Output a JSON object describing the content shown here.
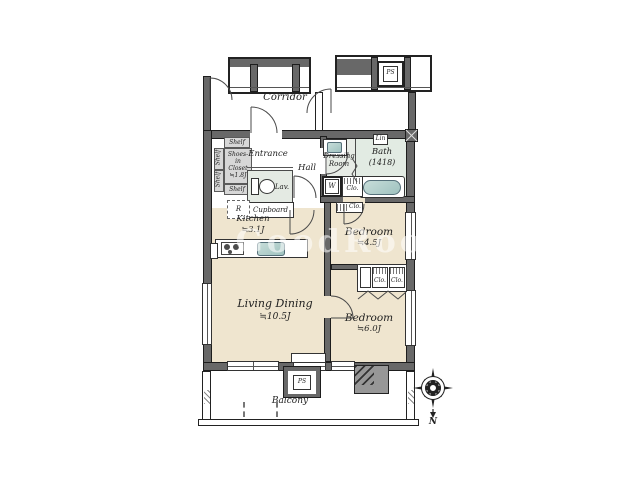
{
  "watermark": "GoodRooM",
  "corridor": {
    "label": "Corridor"
  },
  "top_structures": {
    "pipe_space": "PS"
  },
  "entrance_zone": {
    "entrance": "Entrance",
    "hall": "Hall",
    "lavatory": "Lav.",
    "cupboard": "Cupboard",
    "refrigerator": "R",
    "shelf_top": "Shelf",
    "shelf_side_upper": "Shelf",
    "shelf_side_lower": "Shelf",
    "shelf_bottom": "Shelf",
    "shoes_closet": "Shoes-in Closet ≒1.8J"
  },
  "kitchen": {
    "label": "Kitchen",
    "size": "≒3.1J"
  },
  "living_dining": {
    "label": "Living Dining",
    "size": "≒10.5J"
  },
  "bedroom1": {
    "label": "Bedroom",
    "size": "≒4.5J",
    "closet": "Clo."
  },
  "bedroom2": {
    "label": "Bedroom",
    "size": "≒6.0J",
    "closet_left": "Clo.",
    "closet_right": "Clo."
  },
  "dressing_room": {
    "label": "Dressing Room",
    "washer": "W",
    "closet": "Clo.",
    "linen": "Lin"
  },
  "bath": {
    "label": "Bath",
    "size": "(1418)"
  },
  "balcony": {
    "label": "Balcony",
    "hatch": "PS"
  },
  "compass": {
    "north": "N"
  },
  "colors": {
    "room_beige": "#efe5cf",
    "wet_gray": "#e4eae3",
    "wall_gray": "#686868",
    "fixture_teal": "#a9c9c6"
  }
}
